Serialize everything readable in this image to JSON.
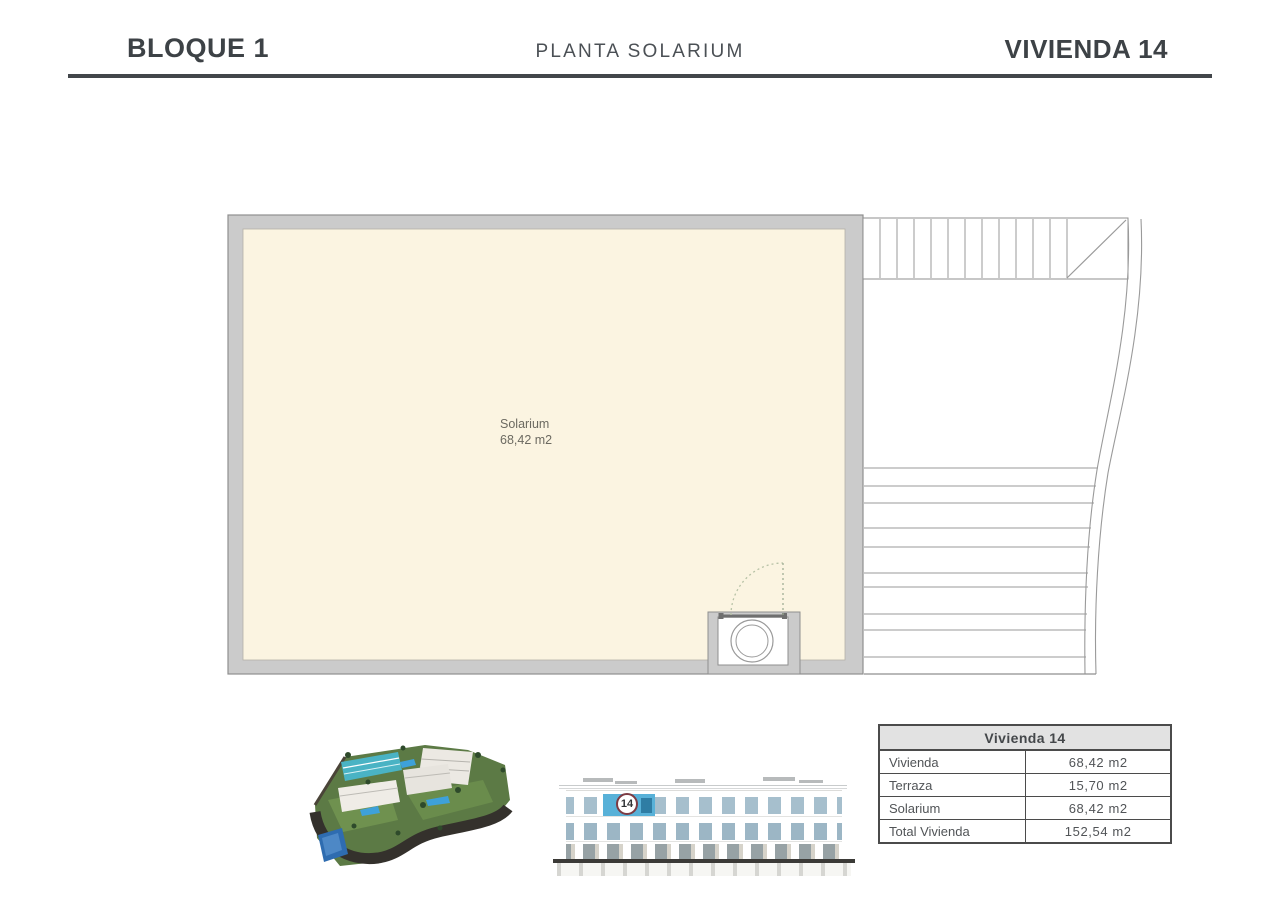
{
  "header": {
    "left_title": "BLOQUE 1",
    "center_title": "PLANTA SOLARIUM",
    "right_title": "VIVIENDA 14"
  },
  "plan": {
    "room_name": "Solarium",
    "room_area": "68,42 m2"
  },
  "elevation": {
    "unit_badge": "14"
  },
  "summary_table": {
    "title": "Vivienda 14",
    "rows": [
      {
        "label": "Vivienda",
        "value": "68,42 m2"
      },
      {
        "label": "Terraza",
        "value": "15,70 m2"
      },
      {
        "label": "Solarium",
        "value": "68,42 m2"
      },
      {
        "label": "Total Vivienda",
        "value": "152,54 m2"
      }
    ]
  },
  "colors": {
    "floor_fill": "#fbf4e1",
    "wall_gray": "#cbcbcb",
    "rule_dark": "#42464a",
    "unit_highlight_blue": "#58b1d8",
    "badge_ring": "#7d3b43",
    "table_header_bg": "#e2e2e2"
  }
}
